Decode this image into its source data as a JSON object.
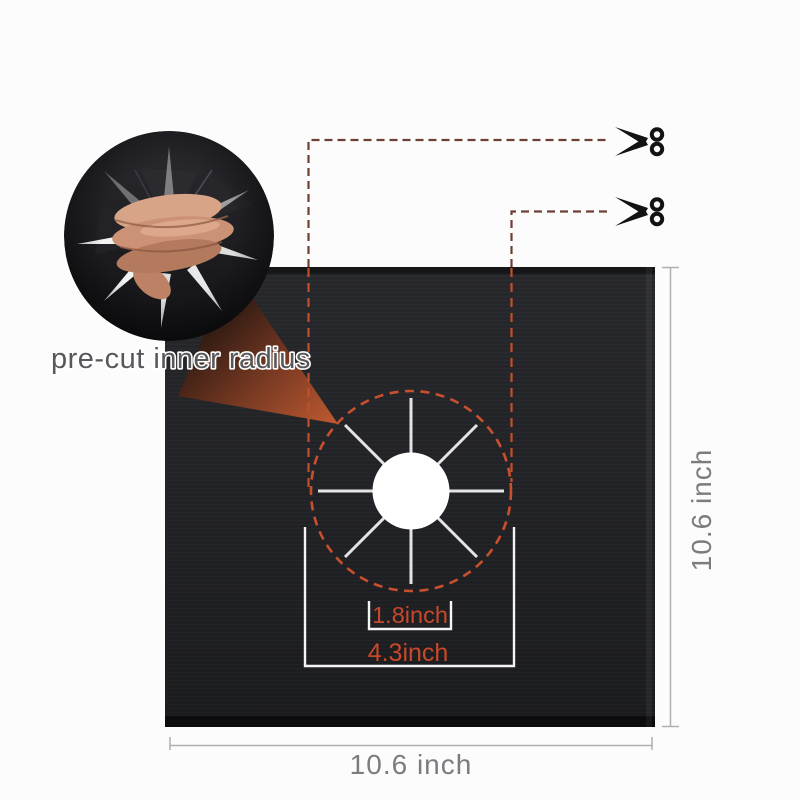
{
  "labels": {
    "callout": "pre-cut inner radius",
    "inner_diameter": "1.8inch",
    "outer_diameter": "4.3inch",
    "mat_width": "10.6 inch",
    "mat_height": "10.6 inch"
  },
  "icons": {
    "scissors": "scissors-icon"
  },
  "colors": {
    "accent_orange": "#c8502e",
    "label_orange": "#c7482a",
    "guide_brown": "#6e4034",
    "mat_black": "#232428",
    "dimension_gray": "#7b7c7f",
    "callout_gray": "#57585b",
    "cut_line_white": "#e4e4e7"
  }
}
